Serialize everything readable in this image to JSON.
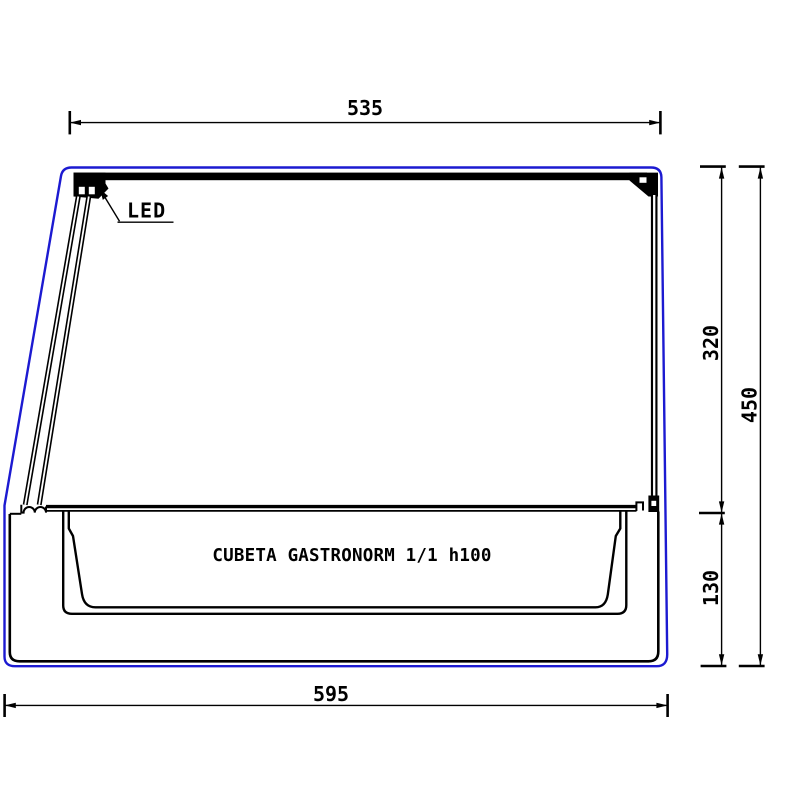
{
  "colors": {
    "outline_blue": "#1c1ad1",
    "line_black": "#000000",
    "background": "#ffffff"
  },
  "labels": {
    "led": "LED",
    "basin": "CUBETA GASTRONORM 1/1 h100"
  },
  "dimensions": {
    "top_width_mm": "535",
    "bottom_width_mm": "595",
    "upper_section_height_mm": "320",
    "total_height_mm": "450",
    "basin_section_height_mm": "130"
  }
}
